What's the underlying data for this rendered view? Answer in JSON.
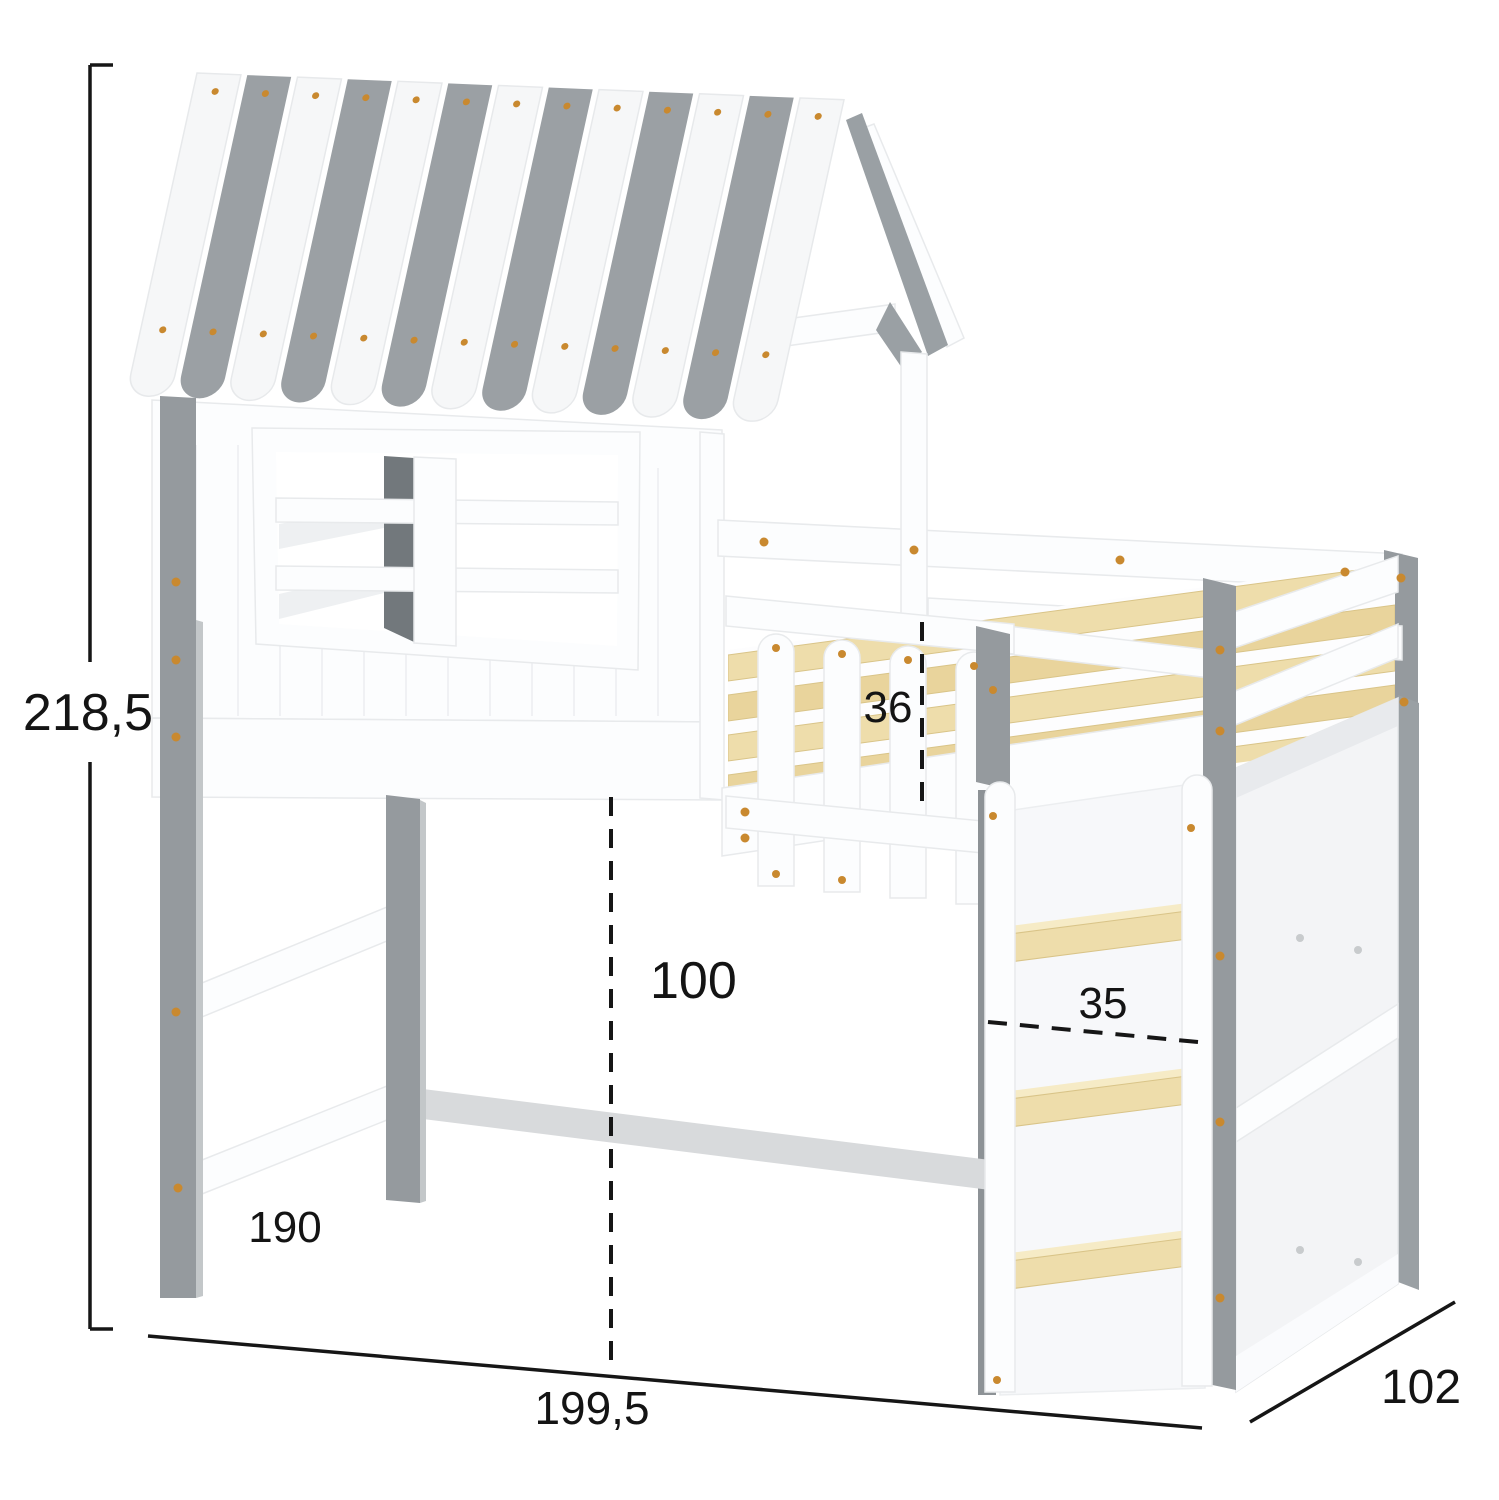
{
  "diagram": {
    "type": "product-dimension-drawing",
    "product": "kids house loft bed with roof, window, ladder and shelf unit",
    "units_shown": false
  },
  "dims": {
    "height": {
      "label": "218,5",
      "meaning": "total height"
    },
    "width": {
      "label": "199,5",
      "meaning": "total width"
    },
    "depth": {
      "label": "102",
      "meaning": "total depth"
    },
    "length": {
      "label": "190",
      "meaning": "inner bed length"
    },
    "clearance": {
      "label": "100",
      "meaning": "clearance under bed"
    },
    "rail": {
      "label": "36",
      "meaning": "guard rail height"
    },
    "ladder": {
      "label": "35",
      "meaning": "ladder width"
    }
  },
  "palette": {
    "roof_gray": "#9ba0a4",
    "roof_white": "#f6f7f8",
    "frame_white": "#fcfdfe",
    "post_gray": "#959a9e",
    "window_post_gray": "#72787c",
    "wood_slat": "#eeddab",
    "screw_gold": "#c9892f",
    "dimension_line": "#161616"
  }
}
